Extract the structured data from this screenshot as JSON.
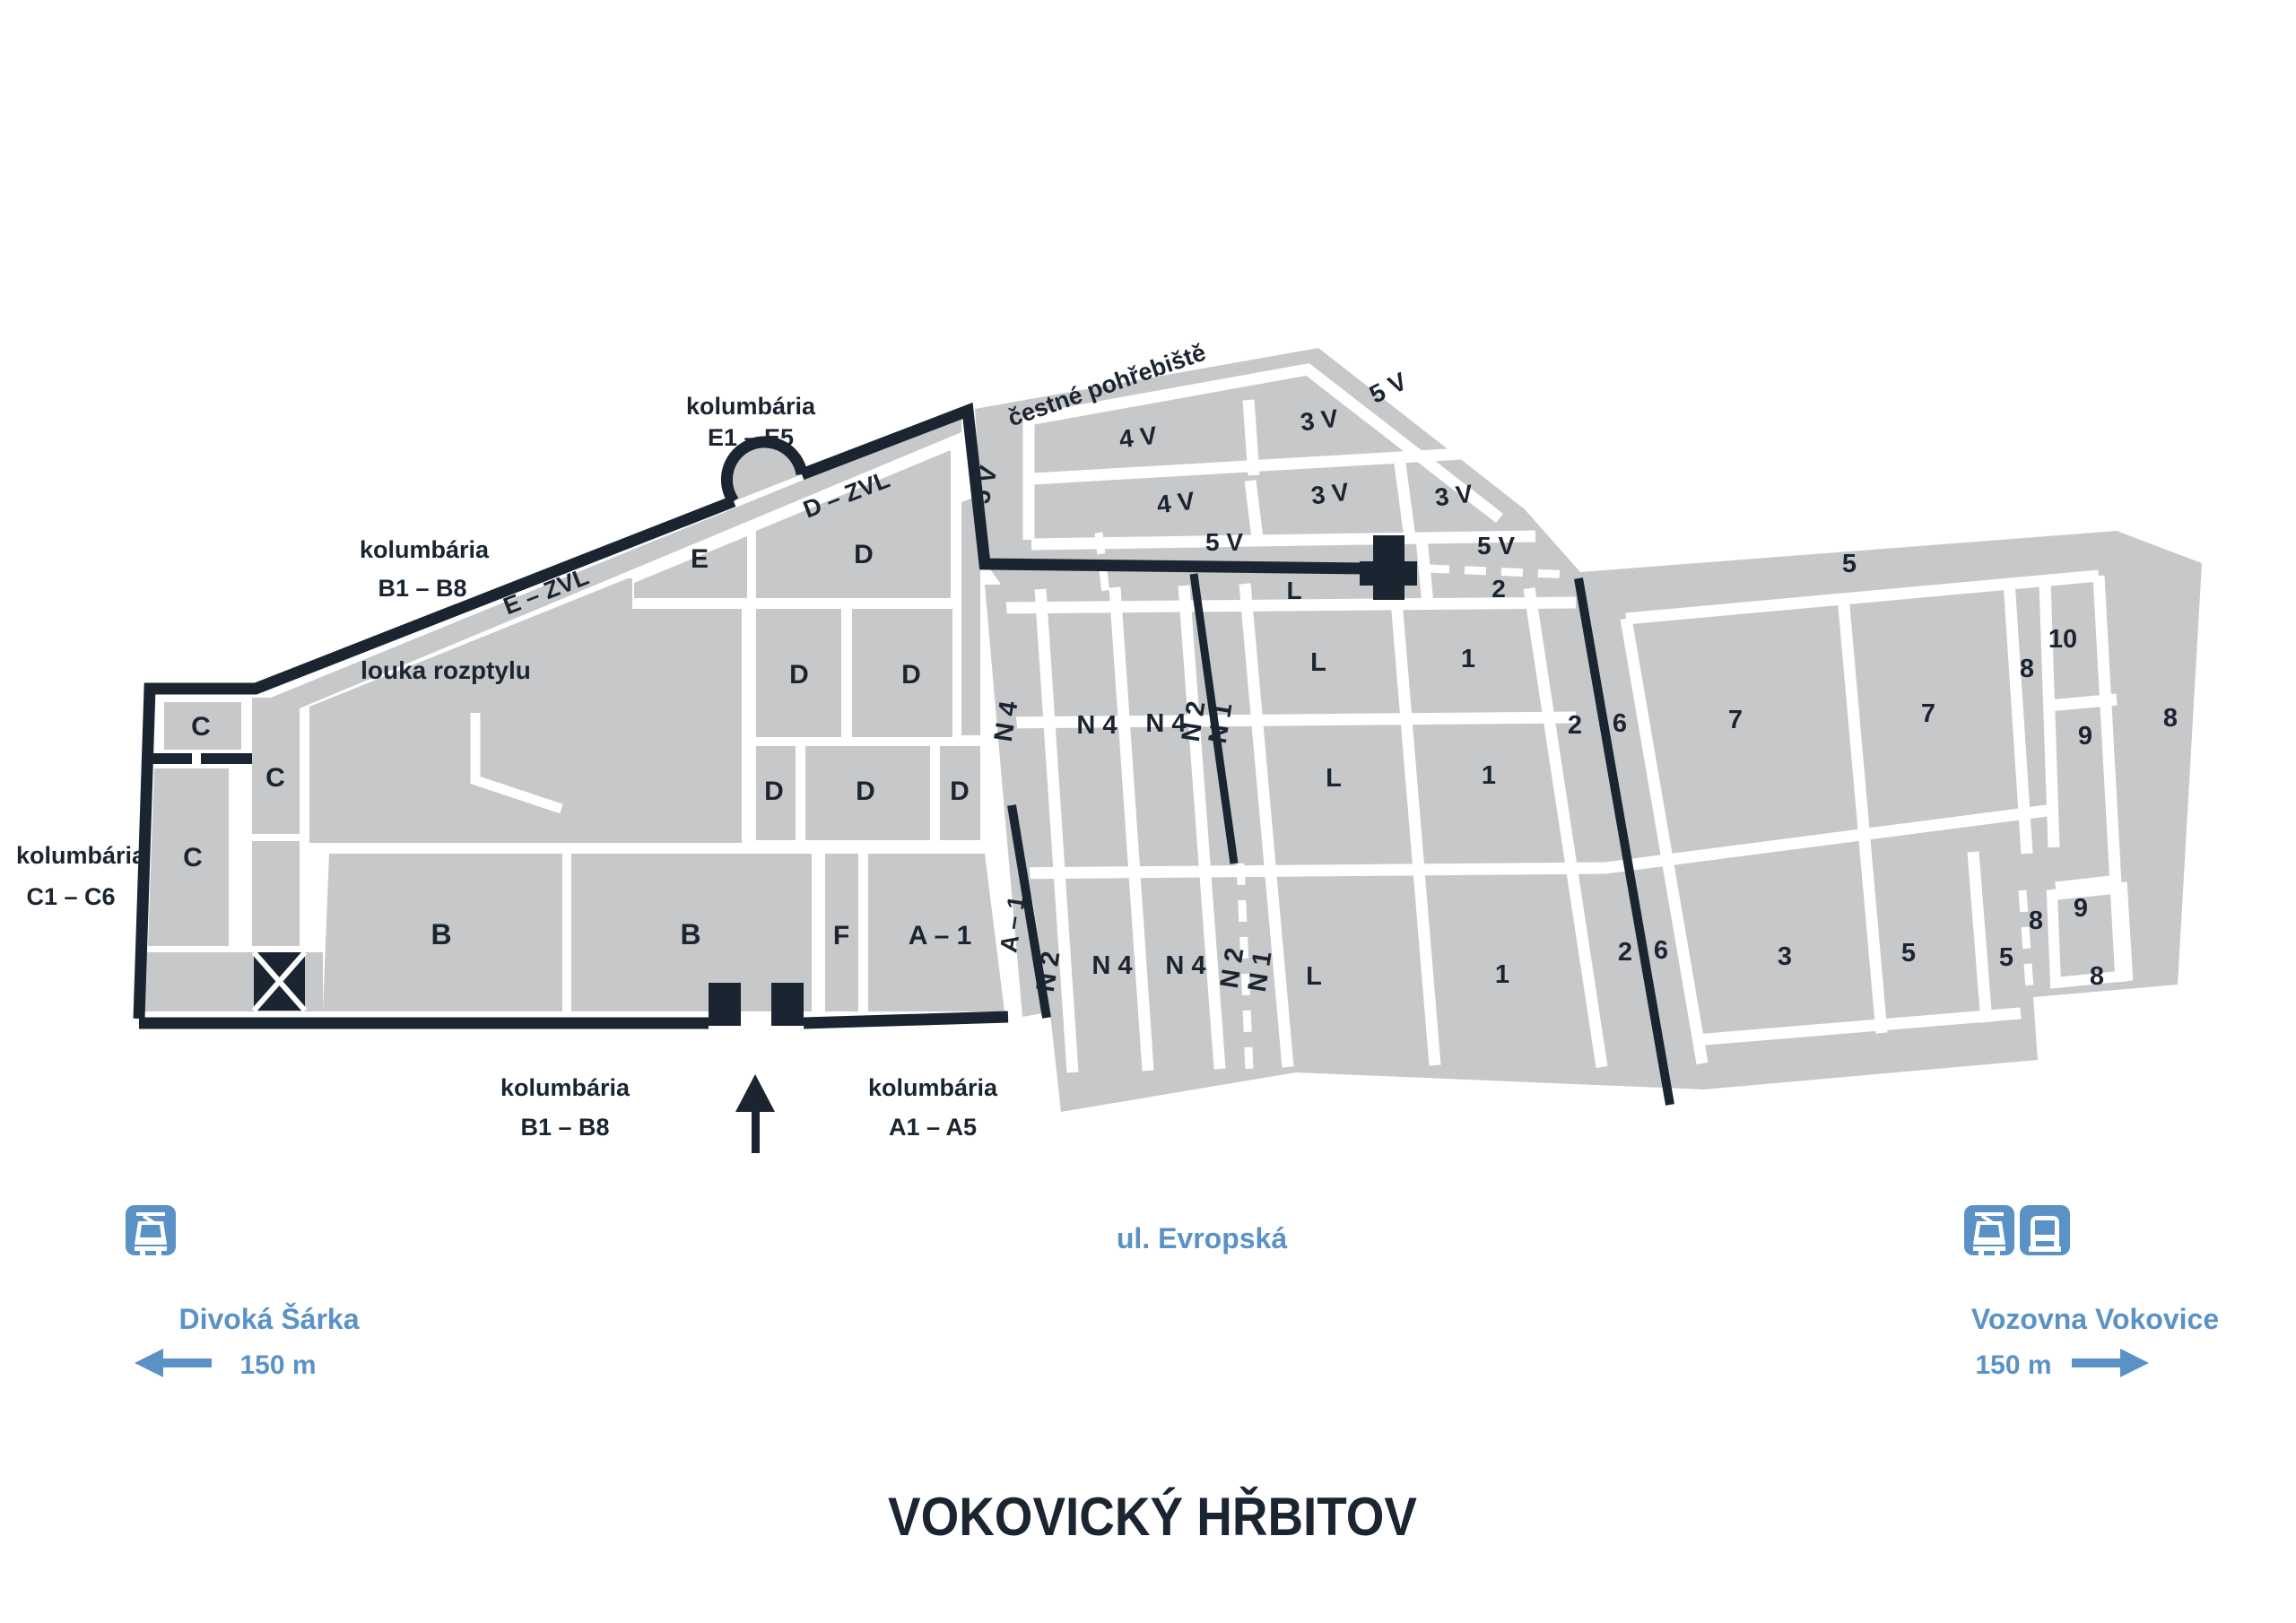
{
  "title": "VOKOVICKÝ HŘBITOV",
  "street": "ul. Evropská",
  "colors": {
    "block_gray": "#c7c8ca",
    "line_dark": "#1b2531",
    "accent_blue": "#5b92c6",
    "background": "#ffffff"
  },
  "legend_left": {
    "stop_name": "Divoká Šárka",
    "distance": "150 m",
    "icons": [
      "tram-icon"
    ]
  },
  "legend_right": {
    "stop_name": "Vozovna Vokovice",
    "distance": "150 m",
    "icons": [
      "tram-icon",
      "bus-icon"
    ]
  },
  "annotations": {
    "kolumbaria_e_1": "kolumbária",
    "kolumbaria_e_2": "E1 – E5",
    "kolumbaria_btop_1": "kolumbária",
    "kolumbaria_btop_2": "B1 – B8",
    "kolumbaria_c_1": "kolumbária",
    "kolumbaria_c_2": "C1 – C6",
    "kolumbaria_bbot_1": "kolumbária",
    "kolumbaria_bbot_2": "B1 – B8",
    "kolumbaria_a_1": "kolumbária",
    "kolumbaria_a_2": "A1 – A5",
    "e_zvl": "E – ZVL",
    "d_zvl": "D – ZVL",
    "louka": "louka rozptylu",
    "cestne": "čestné pohřebiště"
  },
  "labels": {
    "c_top": "C",
    "c_mid": "C",
    "c_tall": "C",
    "b1": "B",
    "b2": "B",
    "f": "F",
    "a1_block": "A – 1",
    "a1_corridor": "A – 1",
    "e": "E",
    "d_top": "D",
    "d_mid_l": "D",
    "d_mid_r": "D",
    "d_bot_1": "D",
    "d_bot_2": "D",
    "d_bot_3": "D",
    "v4_upper": "4 V",
    "v3_upper": "3 V",
    "v4_lower": "4 V",
    "v3_lower": "3 V",
    "v3_right": "3 V",
    "v5_left": "5 V",
    "v5_mid": "5 V",
    "v5_right": "5 V",
    "v5_ne": "5 V",
    "corridor_l": "L",
    "corridor_2": "2",
    "row1_l": "L",
    "row1_1": "1",
    "row2_l": "L",
    "row2_1": "1",
    "row3_l": "L",
    "row3_1": "1",
    "n4_rot_up": "N 4",
    "n4_up1": "N 4",
    "n4_up2": "N 4",
    "n2_rot_up": "N 2",
    "n1_rot_up": "N 1",
    "n2_rot_lo": "N 2",
    "n4_lo1": "N 4",
    "n4_lo2": "N 4",
    "n2_rot_lo2": "N 2",
    "n1_rot_lo2": "N 1",
    "top_5": "5",
    "block_10": "10",
    "s7a": "7",
    "s7b": "7",
    "col_8": "8",
    "s9_up": "9",
    "s8_right": "8",
    "lo_2": "2",
    "lo_6": "6",
    "up_2": "2",
    "up_6": "6",
    "s3": "3",
    "s5a": "5",
    "s5b": "5",
    "s9_lo": "9",
    "s8_dash": "8",
    "s8_bottom": "8"
  }
}
